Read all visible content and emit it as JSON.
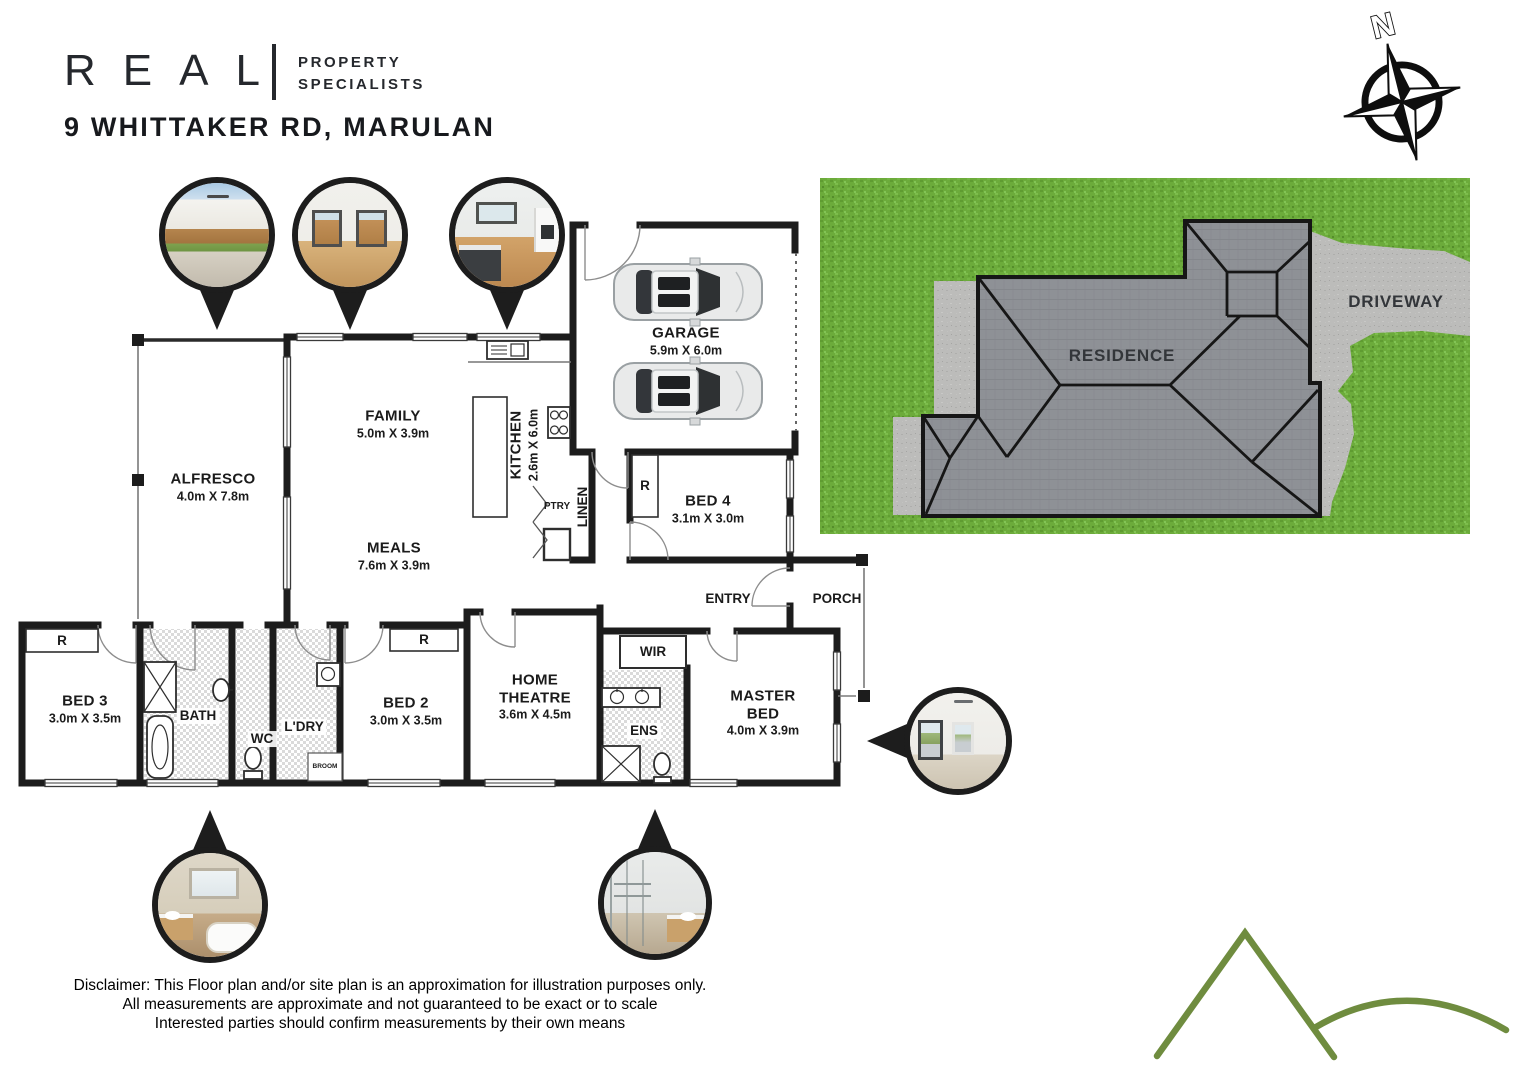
{
  "header": {
    "brand": "REAL",
    "brand_tagline_line1": "PROPERTY",
    "brand_tagline_line2": "SPECIALISTS",
    "address": "9 WHITTAKER RD, MARULAN"
  },
  "compass": {
    "north": "N"
  },
  "site_plan": {
    "residence": "RESIDENCE",
    "driveway": "DRIVEWAY",
    "colors": {
      "grass": "#6cab3b",
      "roof": "#8e9196",
      "paving": "#bcbcba"
    }
  },
  "floor_plan": {
    "rooms": {
      "alfresco": {
        "name": "ALFRESCO",
        "dims": "4.0m X 7.8m"
      },
      "family": {
        "name": "FAMILY",
        "dims": "5.0m X 3.9m"
      },
      "kitchen": {
        "name": "KITCHEN",
        "dims": "2.6m X 6.0m"
      },
      "meals": {
        "name": "MEALS",
        "dims": "7.6m X 3.9m"
      },
      "garage": {
        "name": "GARAGE",
        "dims": "5.9m X 6.0m"
      },
      "bed4": {
        "name": "BED 4",
        "dims": "3.1m X 3.0m"
      },
      "bed3": {
        "name": "BED 3",
        "dims": "3.0m X 3.5m"
      },
      "bed2": {
        "name": "BED 2",
        "dims": "3.0m X 3.5m"
      },
      "home_theatre": {
        "name": "HOME THEATRE",
        "dims": "3.6m X 4.5m"
      },
      "master_bed": {
        "name": "MASTER BED",
        "dims": "4.0m X 3.9m"
      }
    },
    "labels": {
      "pantry": "PTRY",
      "linen": "LINEN",
      "entry": "ENTRY",
      "porch": "PORCH",
      "wir": "WIR",
      "ensuite": "ENS",
      "bath": "BATH",
      "wc": "WC",
      "laundry": "L'DRY",
      "broom": "BROOM",
      "robe": "R"
    }
  },
  "disclaimer": {
    "line1": "Disclaimer: This Floor plan and/or site plan is an approximation for illustration purposes only.",
    "line2": "All measurements are approximate and not guaranteed to be exact or to scale",
    "line3": "Interested parties should confirm measurements by their own means"
  }
}
